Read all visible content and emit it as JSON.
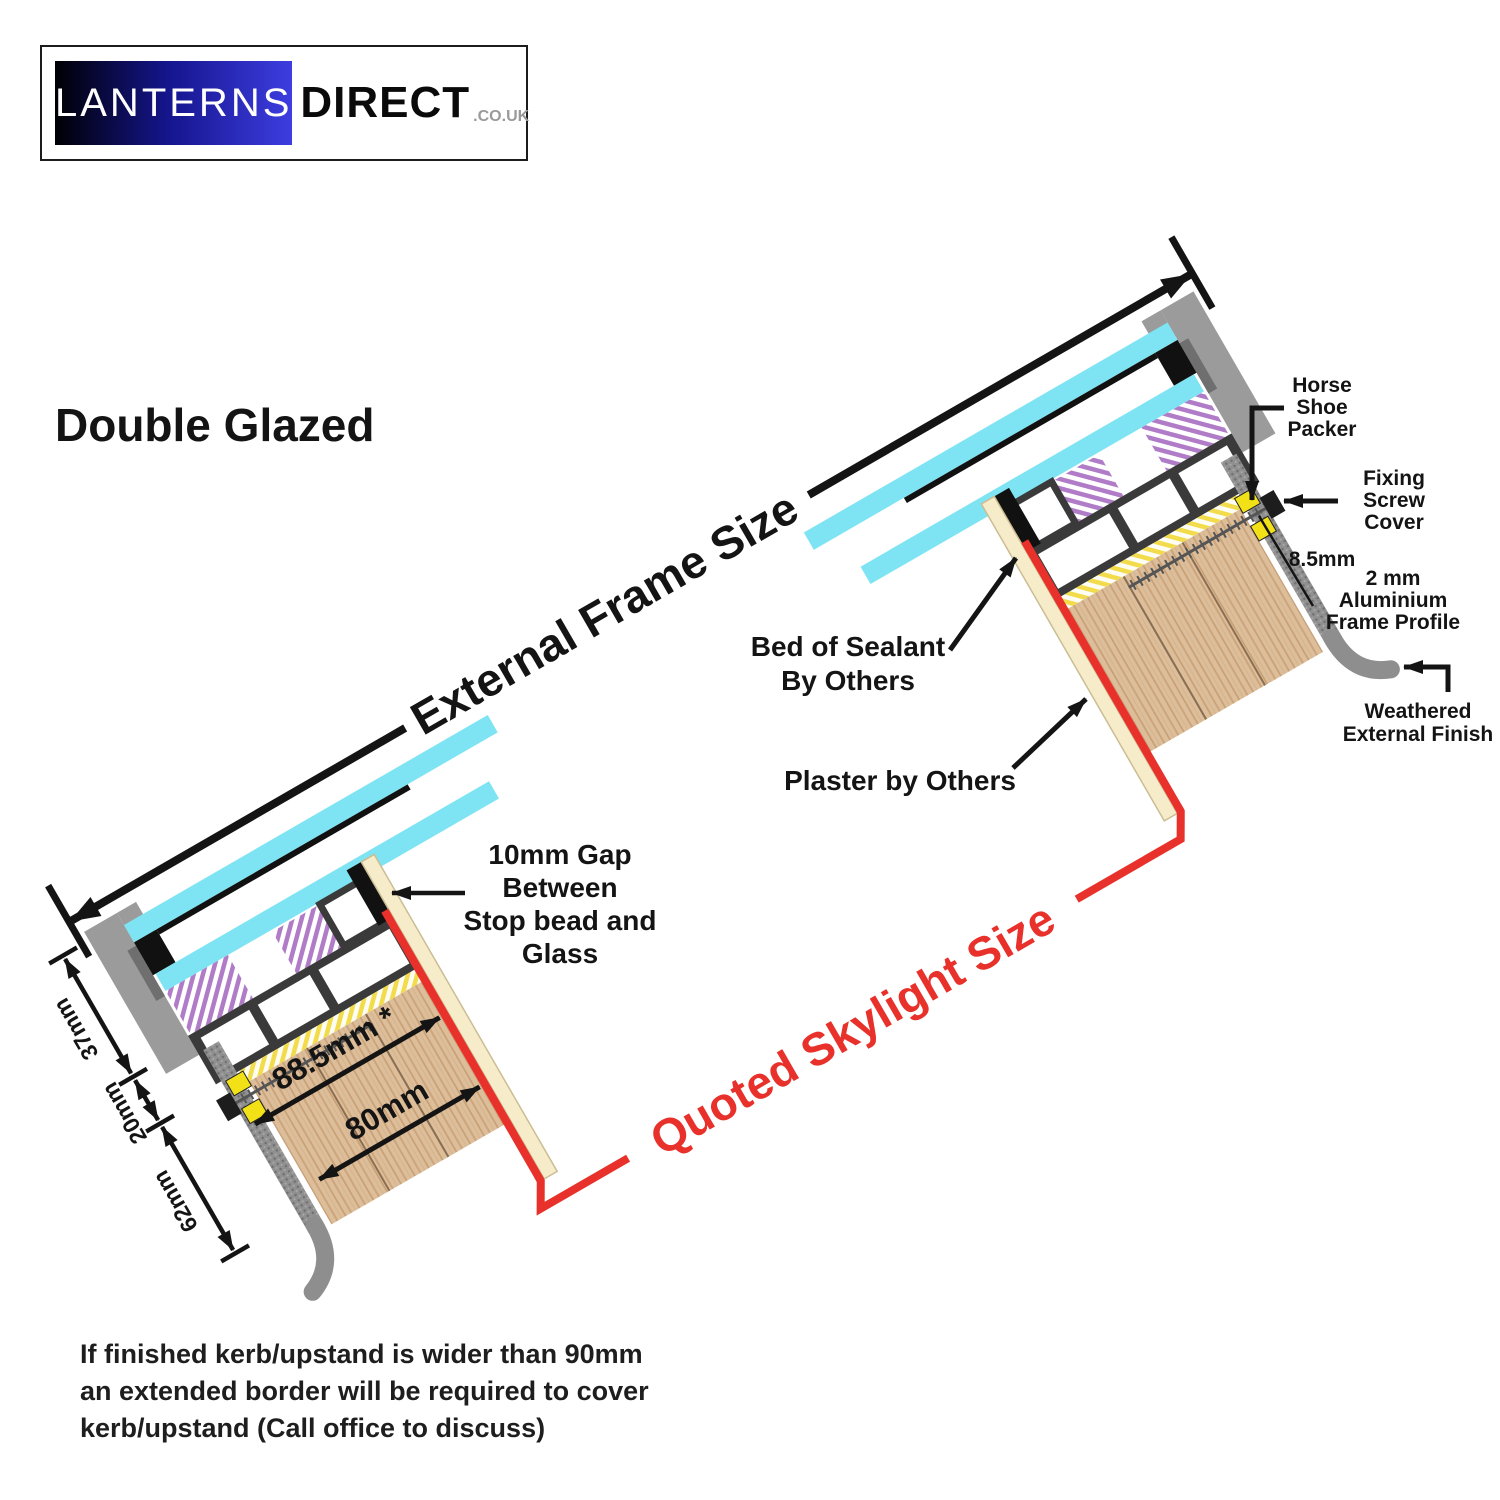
{
  "logo": {
    "lanterns": "LANTERNS",
    "direct": "DIRECT",
    "suffix": ".CO.UK"
  },
  "title": "Double Glazed",
  "dims": {
    "external_frame": "External Frame Size",
    "quoted_skylight": "Quoted Skylight Size",
    "kerb_37": "37mm",
    "kerb_20": "20mm",
    "kerb_62": "62mm",
    "kerb_885": "88.5mm *",
    "kerb_80": "80mm",
    "gap_85": "8.5mm"
  },
  "callouts": {
    "horse_shoe": [
      "Horse",
      "Shoe",
      "Packer"
    ],
    "fixing_screw": [
      "Fixing",
      "Screw",
      "Cover"
    ],
    "alu_profile": [
      "2 mm",
      "Aluminium",
      "Frame Profile"
    ],
    "weathered": [
      "Weathered",
      "External Finish"
    ],
    "sealant": [
      "Bed of Sealant",
      "By Others"
    ],
    "plaster": "Plaster by Others",
    "gap": [
      "10mm Gap",
      "Between",
      "Stop bead and",
      "Glass"
    ]
  },
  "footnote": [
    "If finished kerb/upstand is wider than 90mm",
    "an extended border will be required to cover",
    "kerb/upstand (Call office to discuss)"
  ],
  "colors": {
    "glass": "#7EE4F4",
    "frame_dark": "#3A3A3A",
    "wood": "#DDBE9B",
    "quoted_red": "#E8312B",
    "gasket_purple": "#B07CC8",
    "seal_yellow": "#F2DC4C",
    "packer_yellow": "#F2E117",
    "aluminium_grey": "#8E8E8E",
    "plaster_cream": "#F6ECC9",
    "logo_blue": "#3D3DE0"
  }
}
